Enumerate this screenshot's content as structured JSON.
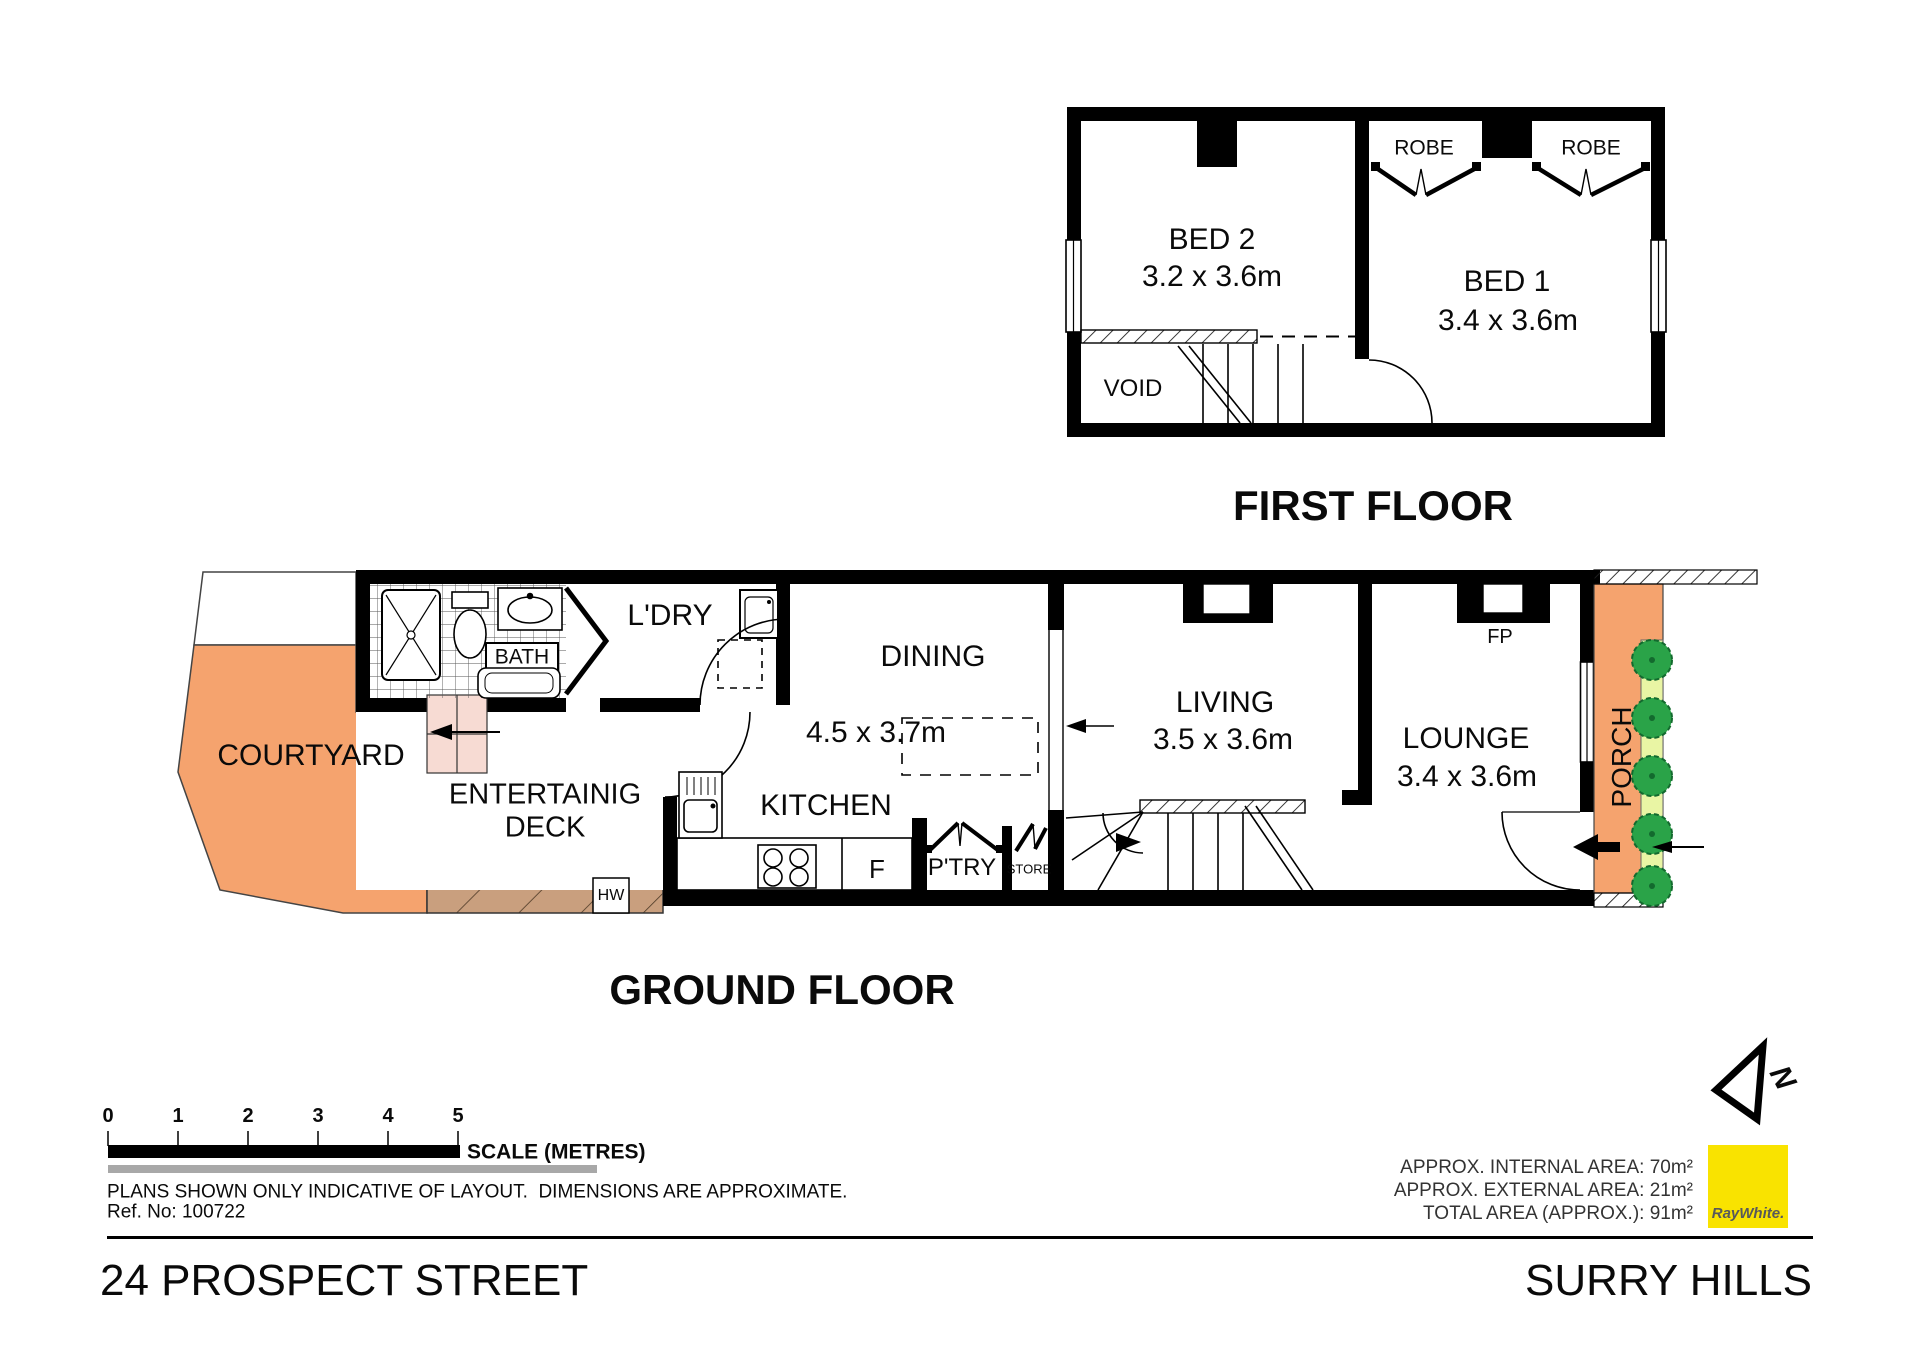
{
  "first_floor": {
    "title": "FIRST FLOOR",
    "bed2": {
      "name": "BED 2",
      "dims": "3.2 x 3.6m"
    },
    "bed1": {
      "name": "BED 1",
      "dims": "3.4 x 3.6m"
    },
    "robe_left": "ROBE",
    "robe_right": "ROBE",
    "void_label": "VOID"
  },
  "ground_floor": {
    "title": "GROUND FLOOR",
    "courtyard": "COURTYARD",
    "deck_line1": "ENTERTAINIG",
    "deck_line2": "DECK",
    "bath": "BATH",
    "laundry": "L'DRY",
    "dining": {
      "name": "DINING",
      "dims": "4.5 x 3.7m"
    },
    "kitchen": "KITCHEN",
    "fridge": "F",
    "pantry": "P'TRY",
    "store": "STORE",
    "hot_water": "HW",
    "living": {
      "name": "LIVING",
      "dims": "3.5 x 3.6m"
    },
    "lounge": {
      "name": "LOUNGE",
      "dims": "3.4 x 3.6m"
    },
    "fireplace": "FP",
    "porch": "PORCH"
  },
  "scale_bar": {
    "ticks": [
      "0",
      "1",
      "2",
      "3",
      "4",
      "5"
    ],
    "label": "SCALE (METRES)"
  },
  "notes": {
    "disclaimer": "PLANS SHOWN ONLY INDICATIVE OF LAYOUT.  DIMENSIONS ARE APPROXIMATE.",
    "ref": "Ref. No: 100722"
  },
  "areas": {
    "internal": "APPROX. INTERNAL AREA: 70m²",
    "external": "APPROX. EXTERNAL AREA: 21m²",
    "total": "TOTAL AREA (APPROX.): 91m²"
  },
  "compass": {
    "north": "N"
  },
  "brand": {
    "name": "RayWhite."
  },
  "footer": {
    "street": "24 PROSPECT STREET",
    "suburb": "SURRY HILLS"
  },
  "colors": {
    "outdoor_orange": "#F5A36E",
    "deck_brown": "#C99F7E",
    "garden_green": "#E9F5A4",
    "bush_green": "#2AA348",
    "brand_yellow": "#F9E300",
    "step_pink": "#F7DBD3"
  }
}
